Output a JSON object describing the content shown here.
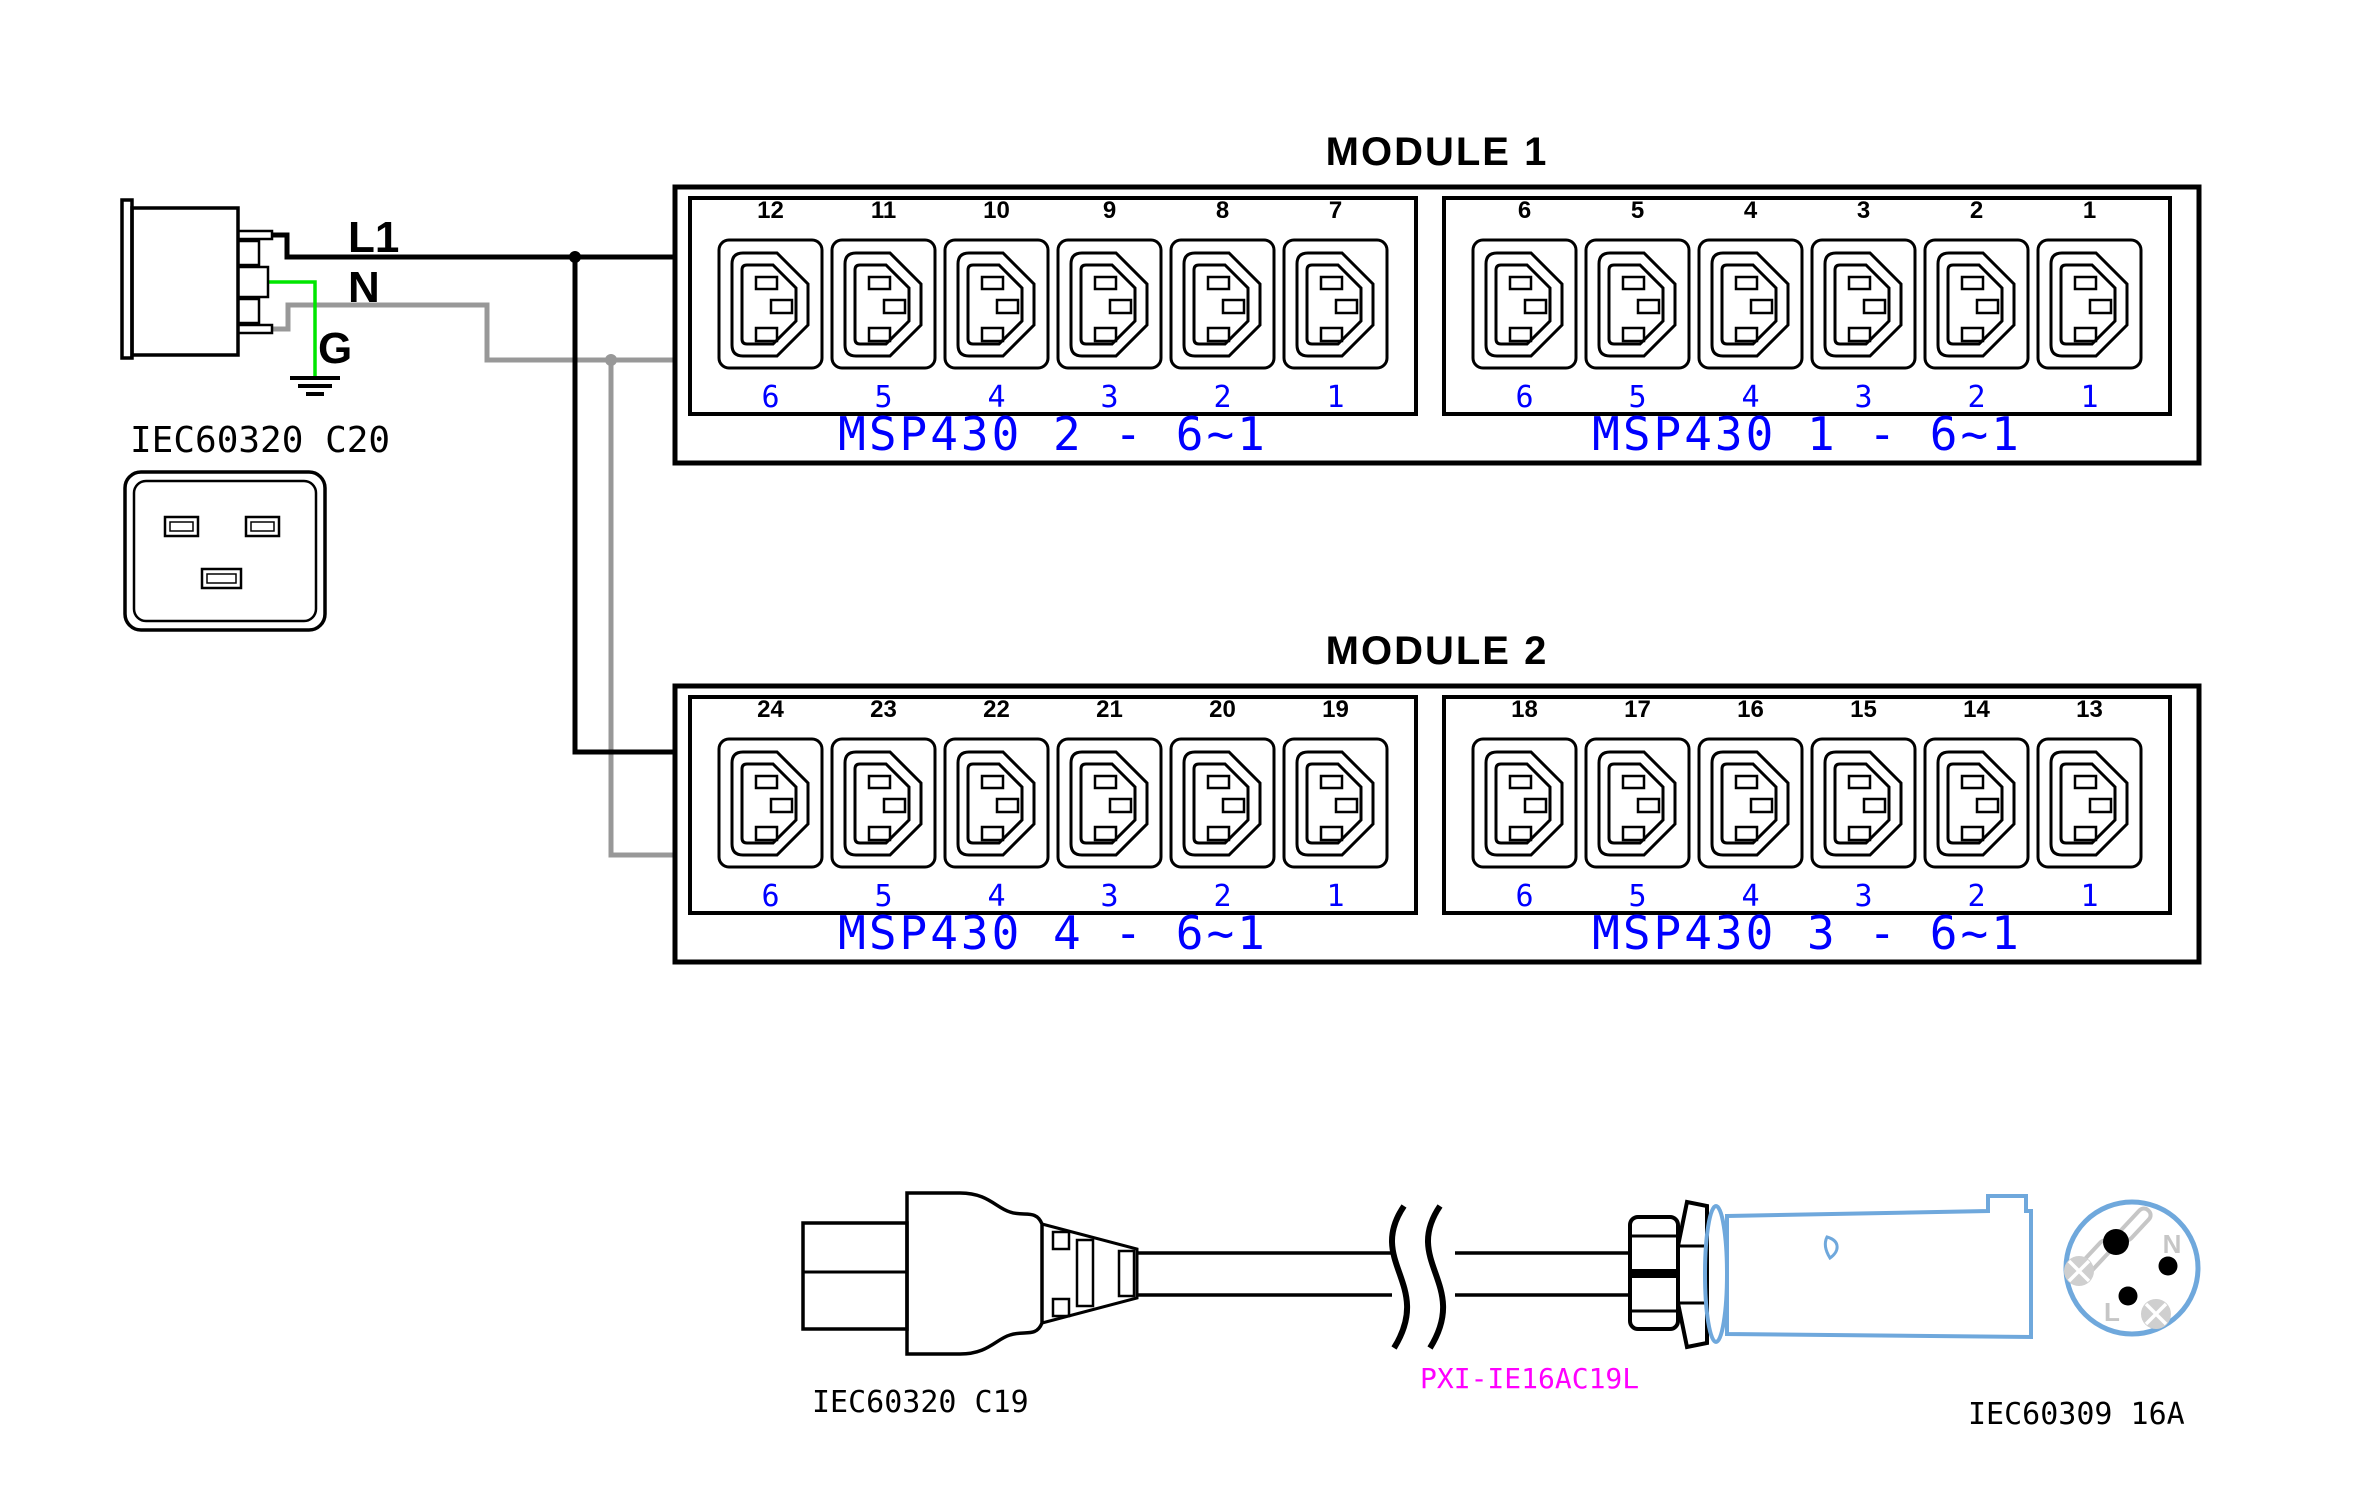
{
  "diagram": {
    "inlet": {
      "label": "IEC60320 C20",
      "wire_labels": {
        "line": "L1",
        "neutral": "N",
        "ground": "G"
      }
    },
    "modules": [
      {
        "title": "MODULE 1",
        "banks": [
          {
            "label": "MSP430 2 - 6~1",
            "outlet_numbers": [
              "12",
              "11",
              "10",
              "9",
              "8",
              "7"
            ],
            "port_numbers": [
              "6",
              "5",
              "4",
              "3",
              "2",
              "1"
            ]
          },
          {
            "label": "MSP430 1 - 6~1",
            "outlet_numbers": [
              "6",
              "5",
              "4",
              "3",
              "2",
              "1"
            ],
            "port_numbers": [
              "6",
              "5",
              "4",
              "3",
              "2",
              "1"
            ]
          }
        ]
      },
      {
        "title": "MODULE 2",
        "banks": [
          {
            "label": "MSP430 4 - 6~1",
            "outlet_numbers": [
              "24",
              "23",
              "22",
              "21",
              "20",
              "19"
            ],
            "port_numbers": [
              "6",
              "5",
              "4",
              "3",
              "2",
              "1"
            ]
          },
          {
            "label": "MSP430 3 - 6~1",
            "outlet_numbers": [
              "18",
              "17",
              "16",
              "15",
              "14",
              "13"
            ],
            "port_numbers": [
              "6",
              "5",
              "4",
              "3",
              "2",
              "1"
            ]
          }
        ]
      }
    ],
    "cable": {
      "left_connector_label": "IEC60320 C19",
      "part_number": "PXI-IE16AC19L",
      "right_connector_label": "IEC60309 16A",
      "plug_pin_labels": {
        "neutral": "N",
        "line": "L"
      }
    },
    "colors": {
      "wire_line": "#000000",
      "wire_neutral": "#989898",
      "wire_ground": "#00E600",
      "module_text": "#0000FF",
      "part_number": "#FF00FF",
      "plug_body": "#6FA8DC"
    }
  }
}
